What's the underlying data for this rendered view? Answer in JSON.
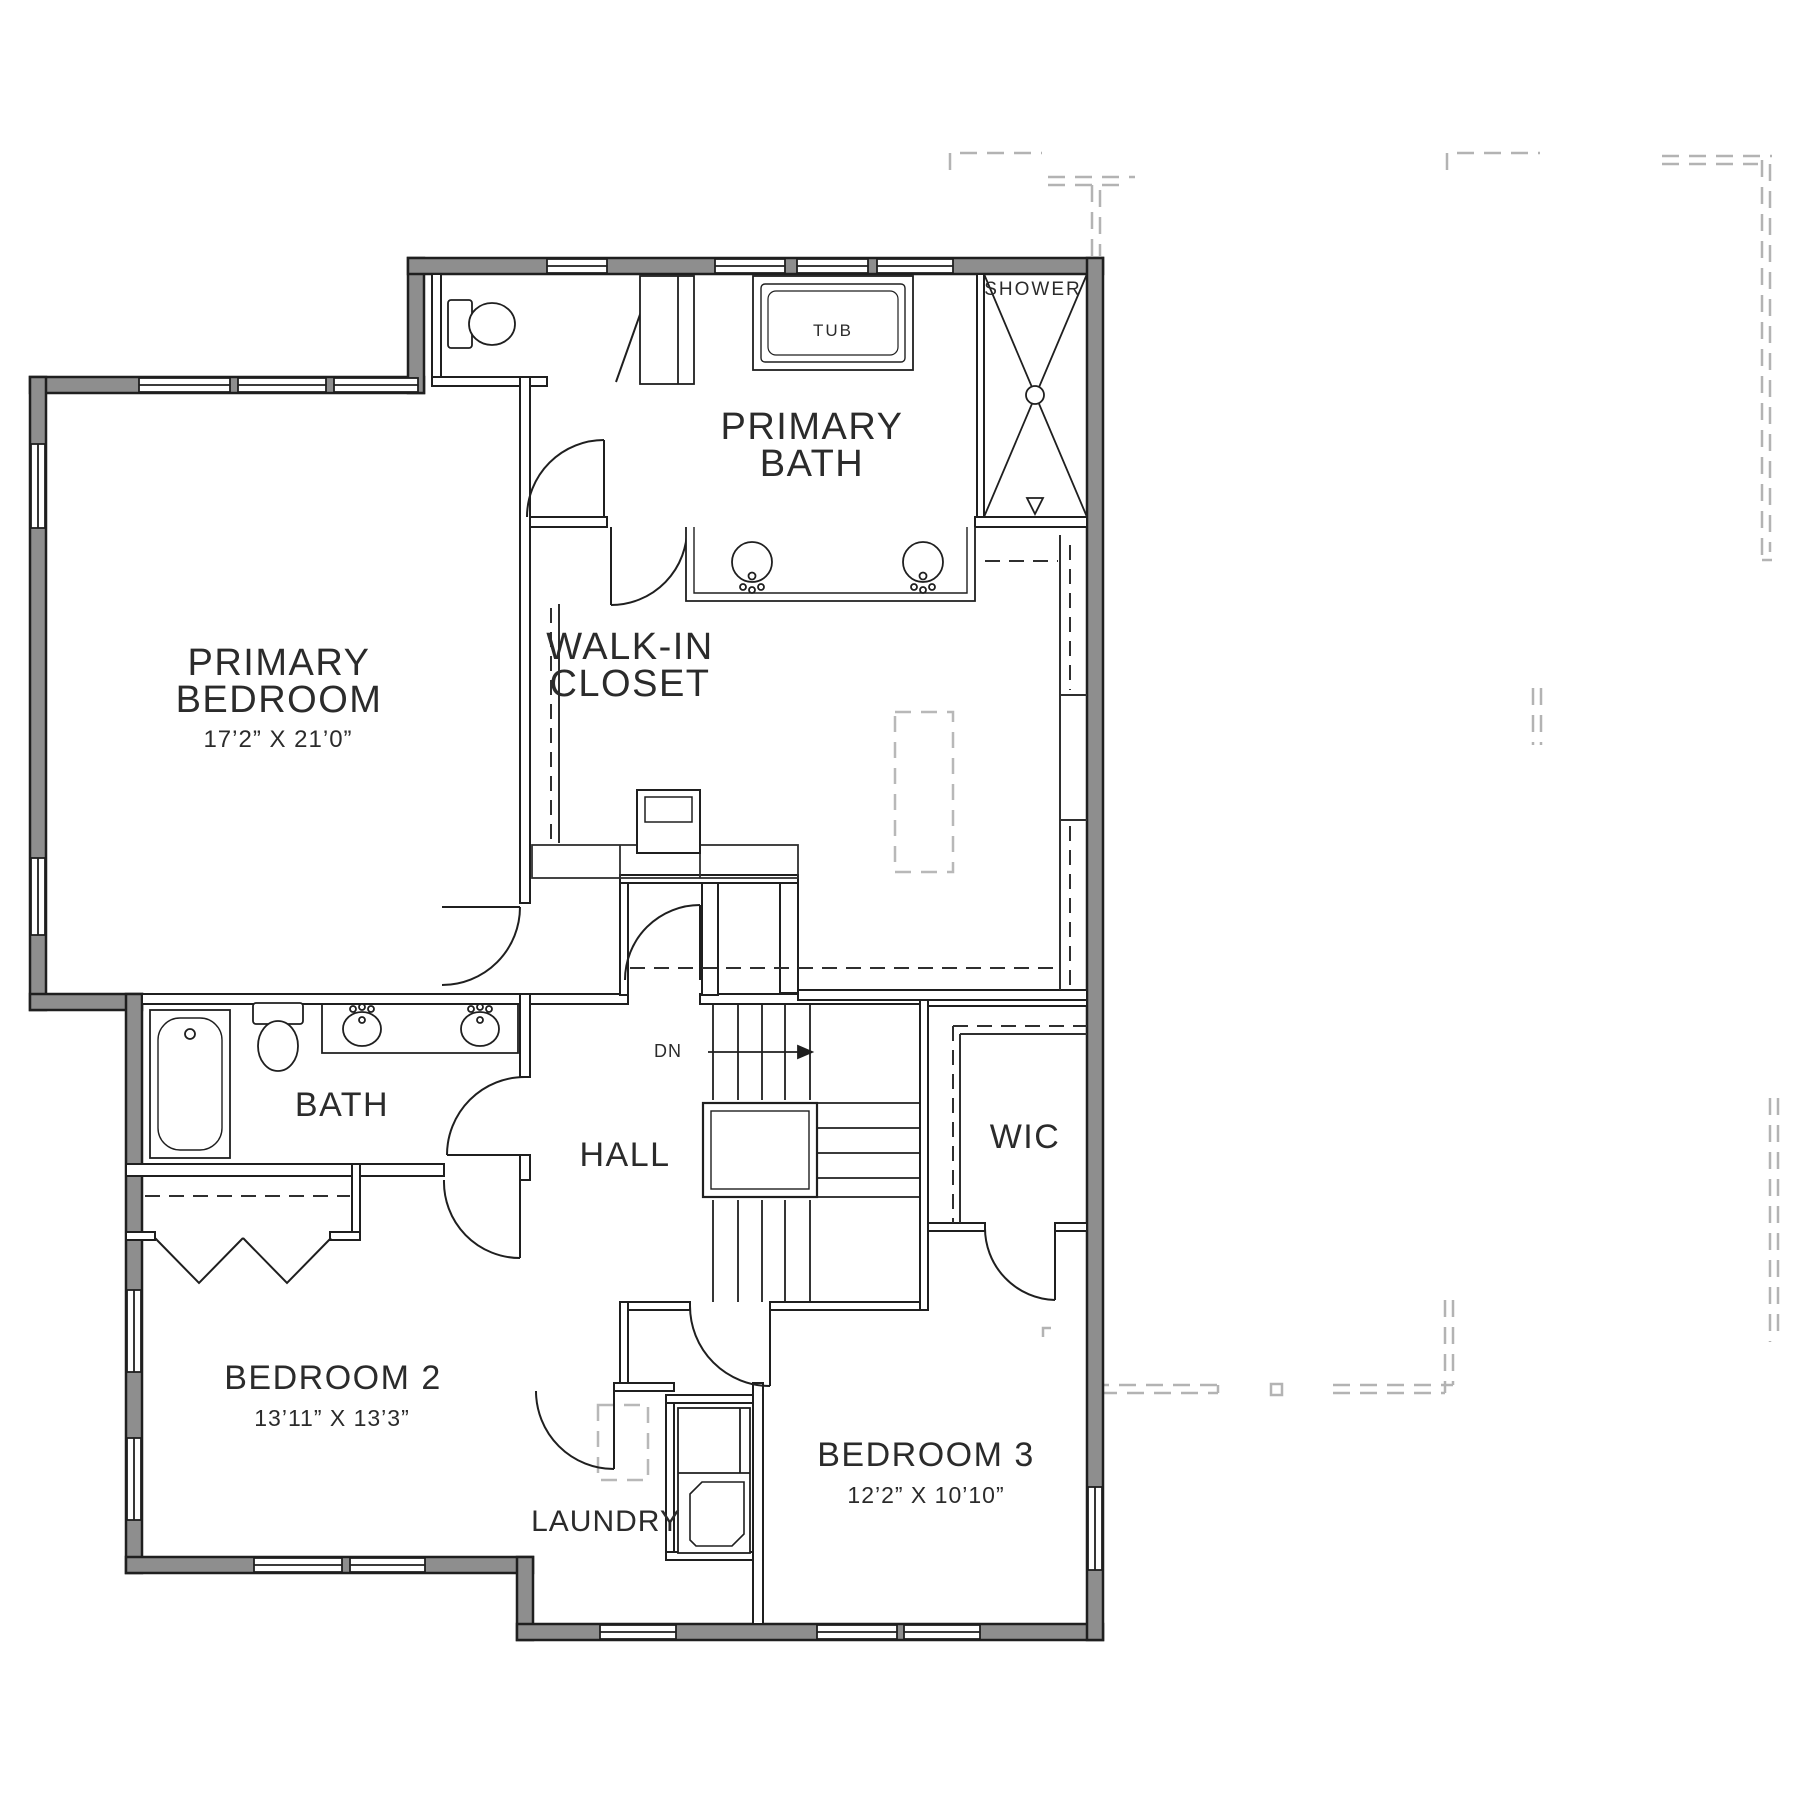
{
  "document": {
    "type": "floor-plan",
    "floor": "upper"
  },
  "labels": {
    "primary_bedroom": {
      "line1": "PRIMARY",
      "line2": "BEDROOM",
      "dims": "17’2” X 21’0”"
    },
    "primary_bath": {
      "line1": "PRIMARY",
      "line2": "BATH"
    },
    "walk_in_closet": {
      "line1": "WALK-IN",
      "line2": "CLOSET"
    },
    "bath": {
      "label": "BATH"
    },
    "hall": {
      "label": "HALL"
    },
    "wic": {
      "label": "WIC"
    },
    "bedroom_2": {
      "label": "BEDROOM 2",
      "dims": "13’11” X 13’3”"
    },
    "bedroom_3": {
      "label": "BEDROOM 3",
      "dims": "12’2” X 10’10”"
    },
    "laundry": {
      "label": "LAUNDRY"
    },
    "tub": {
      "label": "TUB"
    },
    "shower": {
      "label": "SHOWER"
    },
    "stairs": {
      "dn": "DN"
    }
  },
  "colors": {
    "wall_fill": "#8e8e8e",
    "line_color": "#1f1f1f",
    "roof_dash_color": "#b3b3b3",
    "text_color": "#2b2b2b",
    "background": "#ffffff"
  }
}
